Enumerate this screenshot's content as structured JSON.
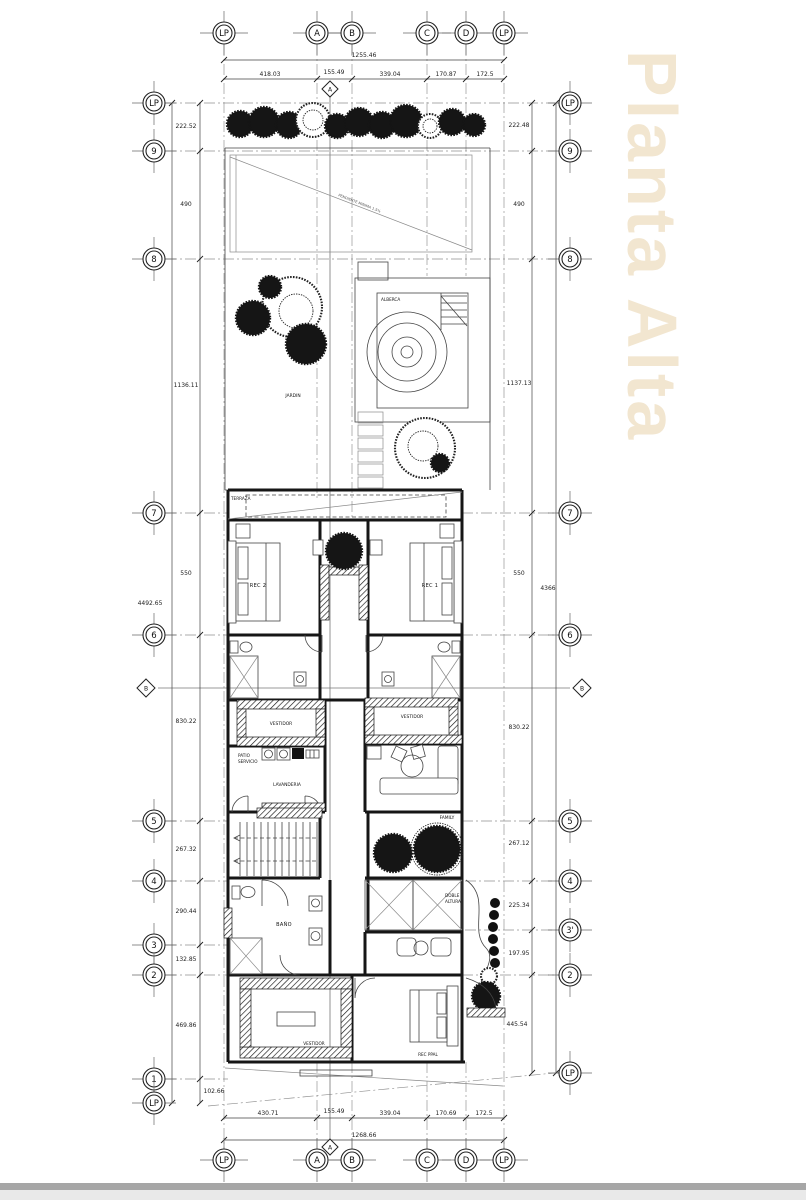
{
  "title": {
    "watermark": "Planta Alta"
  },
  "colors": {
    "watermark": "#f2e6d0",
    "linework": "#161616",
    "grid": "#909090",
    "footer_bar": "#a6a6a6"
  },
  "axes": {
    "top": [
      "LP",
      "A",
      "B",
      "C",
      "D",
      "LP"
    ],
    "bottom": [
      "LP",
      "A",
      "B",
      "C",
      "D",
      "LP"
    ],
    "left": [
      "LP",
      "9",
      "8",
      "7",
      "6",
      "5",
      "4",
      "3",
      "2",
      "1",
      "LP"
    ],
    "right": [
      "LP",
      "9",
      "8",
      "7",
      "6",
      "5",
      "4",
      "3'",
      "2",
      "LP"
    ],
    "sections": {
      "a": "A",
      "b": "B"
    }
  },
  "dims": {
    "top": {
      "overall": "1255.46",
      "segments": [
        "418.03",
        "155.49",
        "339.04",
        "170.87",
        "172.5"
      ]
    },
    "bottom": {
      "overall": "1268.66",
      "segments": [
        "430.71",
        "155.49",
        "339.04",
        "170.69",
        "172.5"
      ]
    },
    "left": {
      "overall": "4492.65",
      "segments": [
        "222.52",
        "490",
        "1136.11",
        "550",
        "830.22",
        "267.32",
        "290.44",
        "132.85",
        "469.86",
        "102.66"
      ]
    },
    "right": {
      "overall": "4366",
      "segments": [
        "222.48",
        "490",
        "1137.13",
        "550",
        "830.22",
        "267.12",
        "225.34",
        "197.95",
        "445.54"
      ]
    }
  },
  "labels": {
    "terraza": "TERRAZA",
    "alberca": "ALBERCA",
    "jardin": "JARDIN",
    "rec2": "REC 2",
    "rec1": "REC 1",
    "vestidor": "VESTIDOR",
    "patio_line1": "PATIO",
    "patio_line2": "SERVICIO",
    "lavanderia": "LAVANDERIA",
    "family": "FAMILY",
    "doble_line1": "DOBLE",
    "doble_line2": "ALTURA",
    "bano": "BAÑO",
    "rec_ppal": "REC PPAL",
    "roof_note": "PENDIENTE MINIMA 1.5%"
  }
}
